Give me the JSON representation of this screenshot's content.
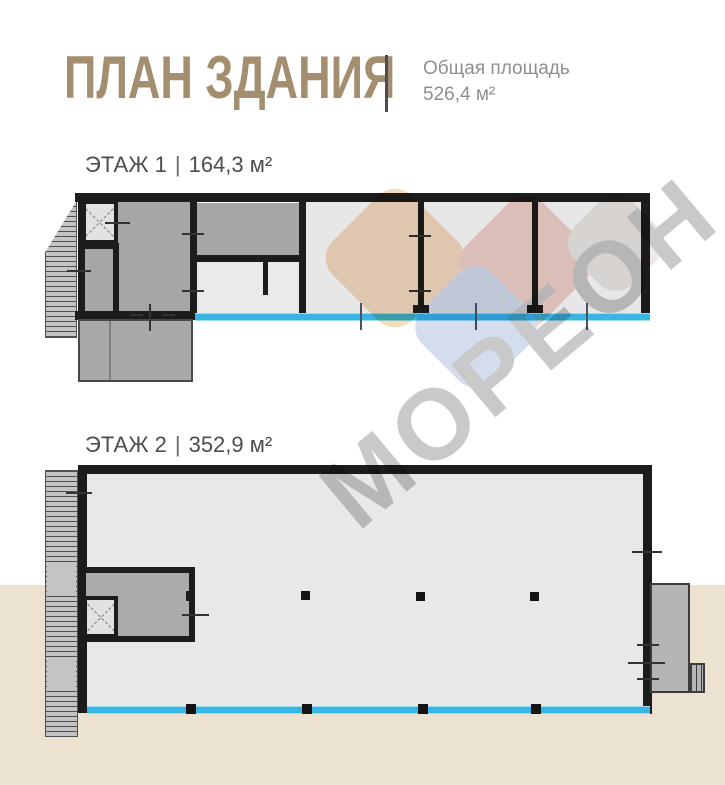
{
  "header": {
    "title": "ПЛАН ЗДАНИЯ",
    "summary_label": "Общая площадь",
    "summary_value": "526,4 м²"
  },
  "floors": [
    {
      "name": "ЭТАЖ 1",
      "separator": "|",
      "area": "164,3 м²"
    },
    {
      "name": "ЭТАЖ 2",
      "separator": "|",
      "area": "352,9 м²"
    }
  ],
  "watermark": {
    "text": "МОРЕОН"
  },
  "colors": {
    "title_tan": "#a38e70",
    "window_cyan": "#38b6e3",
    "wall_black": "#1c1c1c",
    "room_dark_gray": "#a6a6a6",
    "room_light_gray": "#e7e7e7",
    "ground_beige": "#ebe2d0",
    "watermark_gray": "#c9c9c9"
  }
}
